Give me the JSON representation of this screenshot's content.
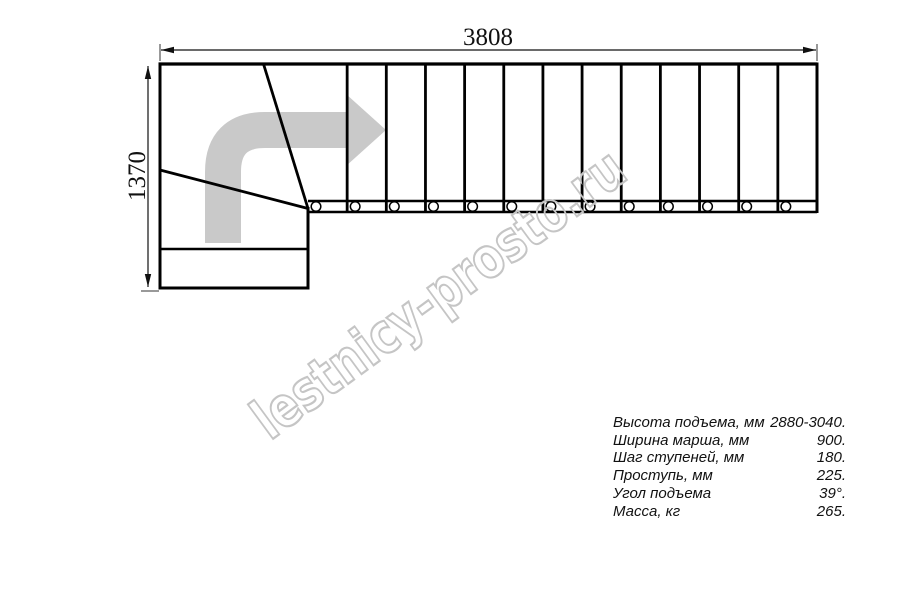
{
  "drawing": {
    "width_label": "3808",
    "height_label": "1370",
    "stair": {
      "straight_treads": 13,
      "screw_count": 13,
      "winder_tread_lines": 2
    }
  },
  "watermark": {
    "text": "lestnicy-prosto.ru"
  },
  "specs": {
    "rows": [
      {
        "label": "Высота подъема, мм",
        "value": "2880-3040."
      },
      {
        "label": "Ширина марша, мм",
        "value": "900."
      },
      {
        "label": "Шаг ступеней, мм",
        "value": "180."
      },
      {
        "label": "Проступь, мм",
        "value": "225."
      },
      {
        "label": "Угол подъема",
        "value": "39°."
      },
      {
        "label": "Масса, кг",
        "value": "265."
      }
    ]
  },
  "colors": {
    "line": "#000000",
    "arrow_gray": "#c9c9c9",
    "watermark_gray": "#c5c5c5"
  }
}
